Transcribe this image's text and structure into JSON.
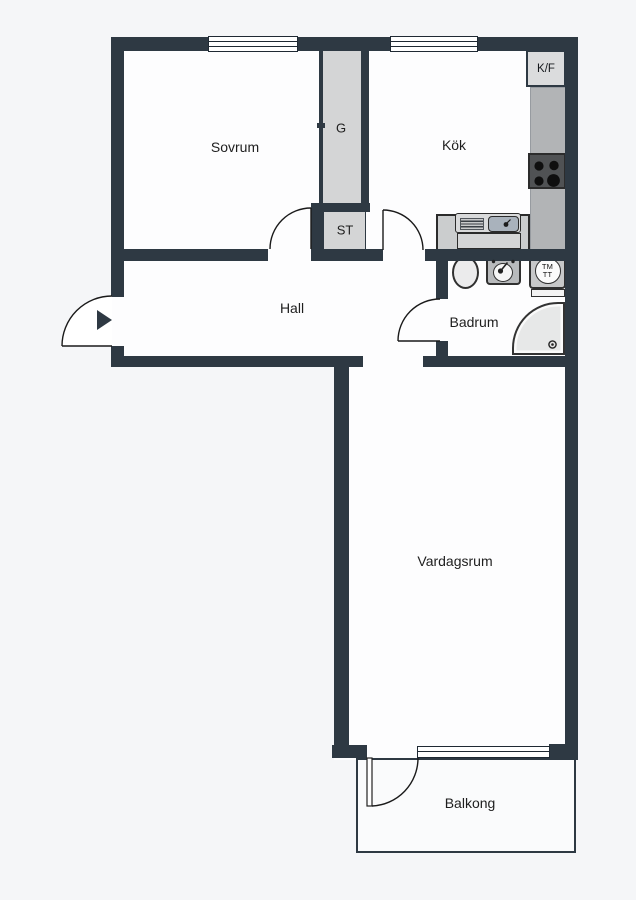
{
  "floorplan": {
    "rooms": {
      "sovrum": {
        "label": "Sovrum"
      },
      "kok": {
        "label": "Kök"
      },
      "hall": {
        "label": "Hall"
      },
      "badrum": {
        "label": "Badrum"
      },
      "vardagsrum": {
        "label": "Vardagsrum"
      },
      "balkong": {
        "label": "Balkong"
      }
    },
    "closets": {
      "g": {
        "label": "G"
      },
      "st": {
        "label": "ST"
      }
    },
    "appliances": {
      "fridge_freezer": {
        "label": "K/F"
      },
      "washer_dryer": {
        "label_top": "TM",
        "label_bottom": "TT"
      }
    },
    "colors": {
      "wall": "#2e3943",
      "background": "#f5f6f8",
      "room_fill": "#fdfdfe",
      "closet_fill": "#d4d5d6",
      "counter": "#b2b4b6",
      "appliance_box": "#dbdcdd",
      "stove_panel": "#505254",
      "burner": "#0f0f0f",
      "sink_basin": "#a9b2bc",
      "fixture_gray": "#c7c8c9",
      "shower_fill": "#e7e8e8"
    }
  }
}
